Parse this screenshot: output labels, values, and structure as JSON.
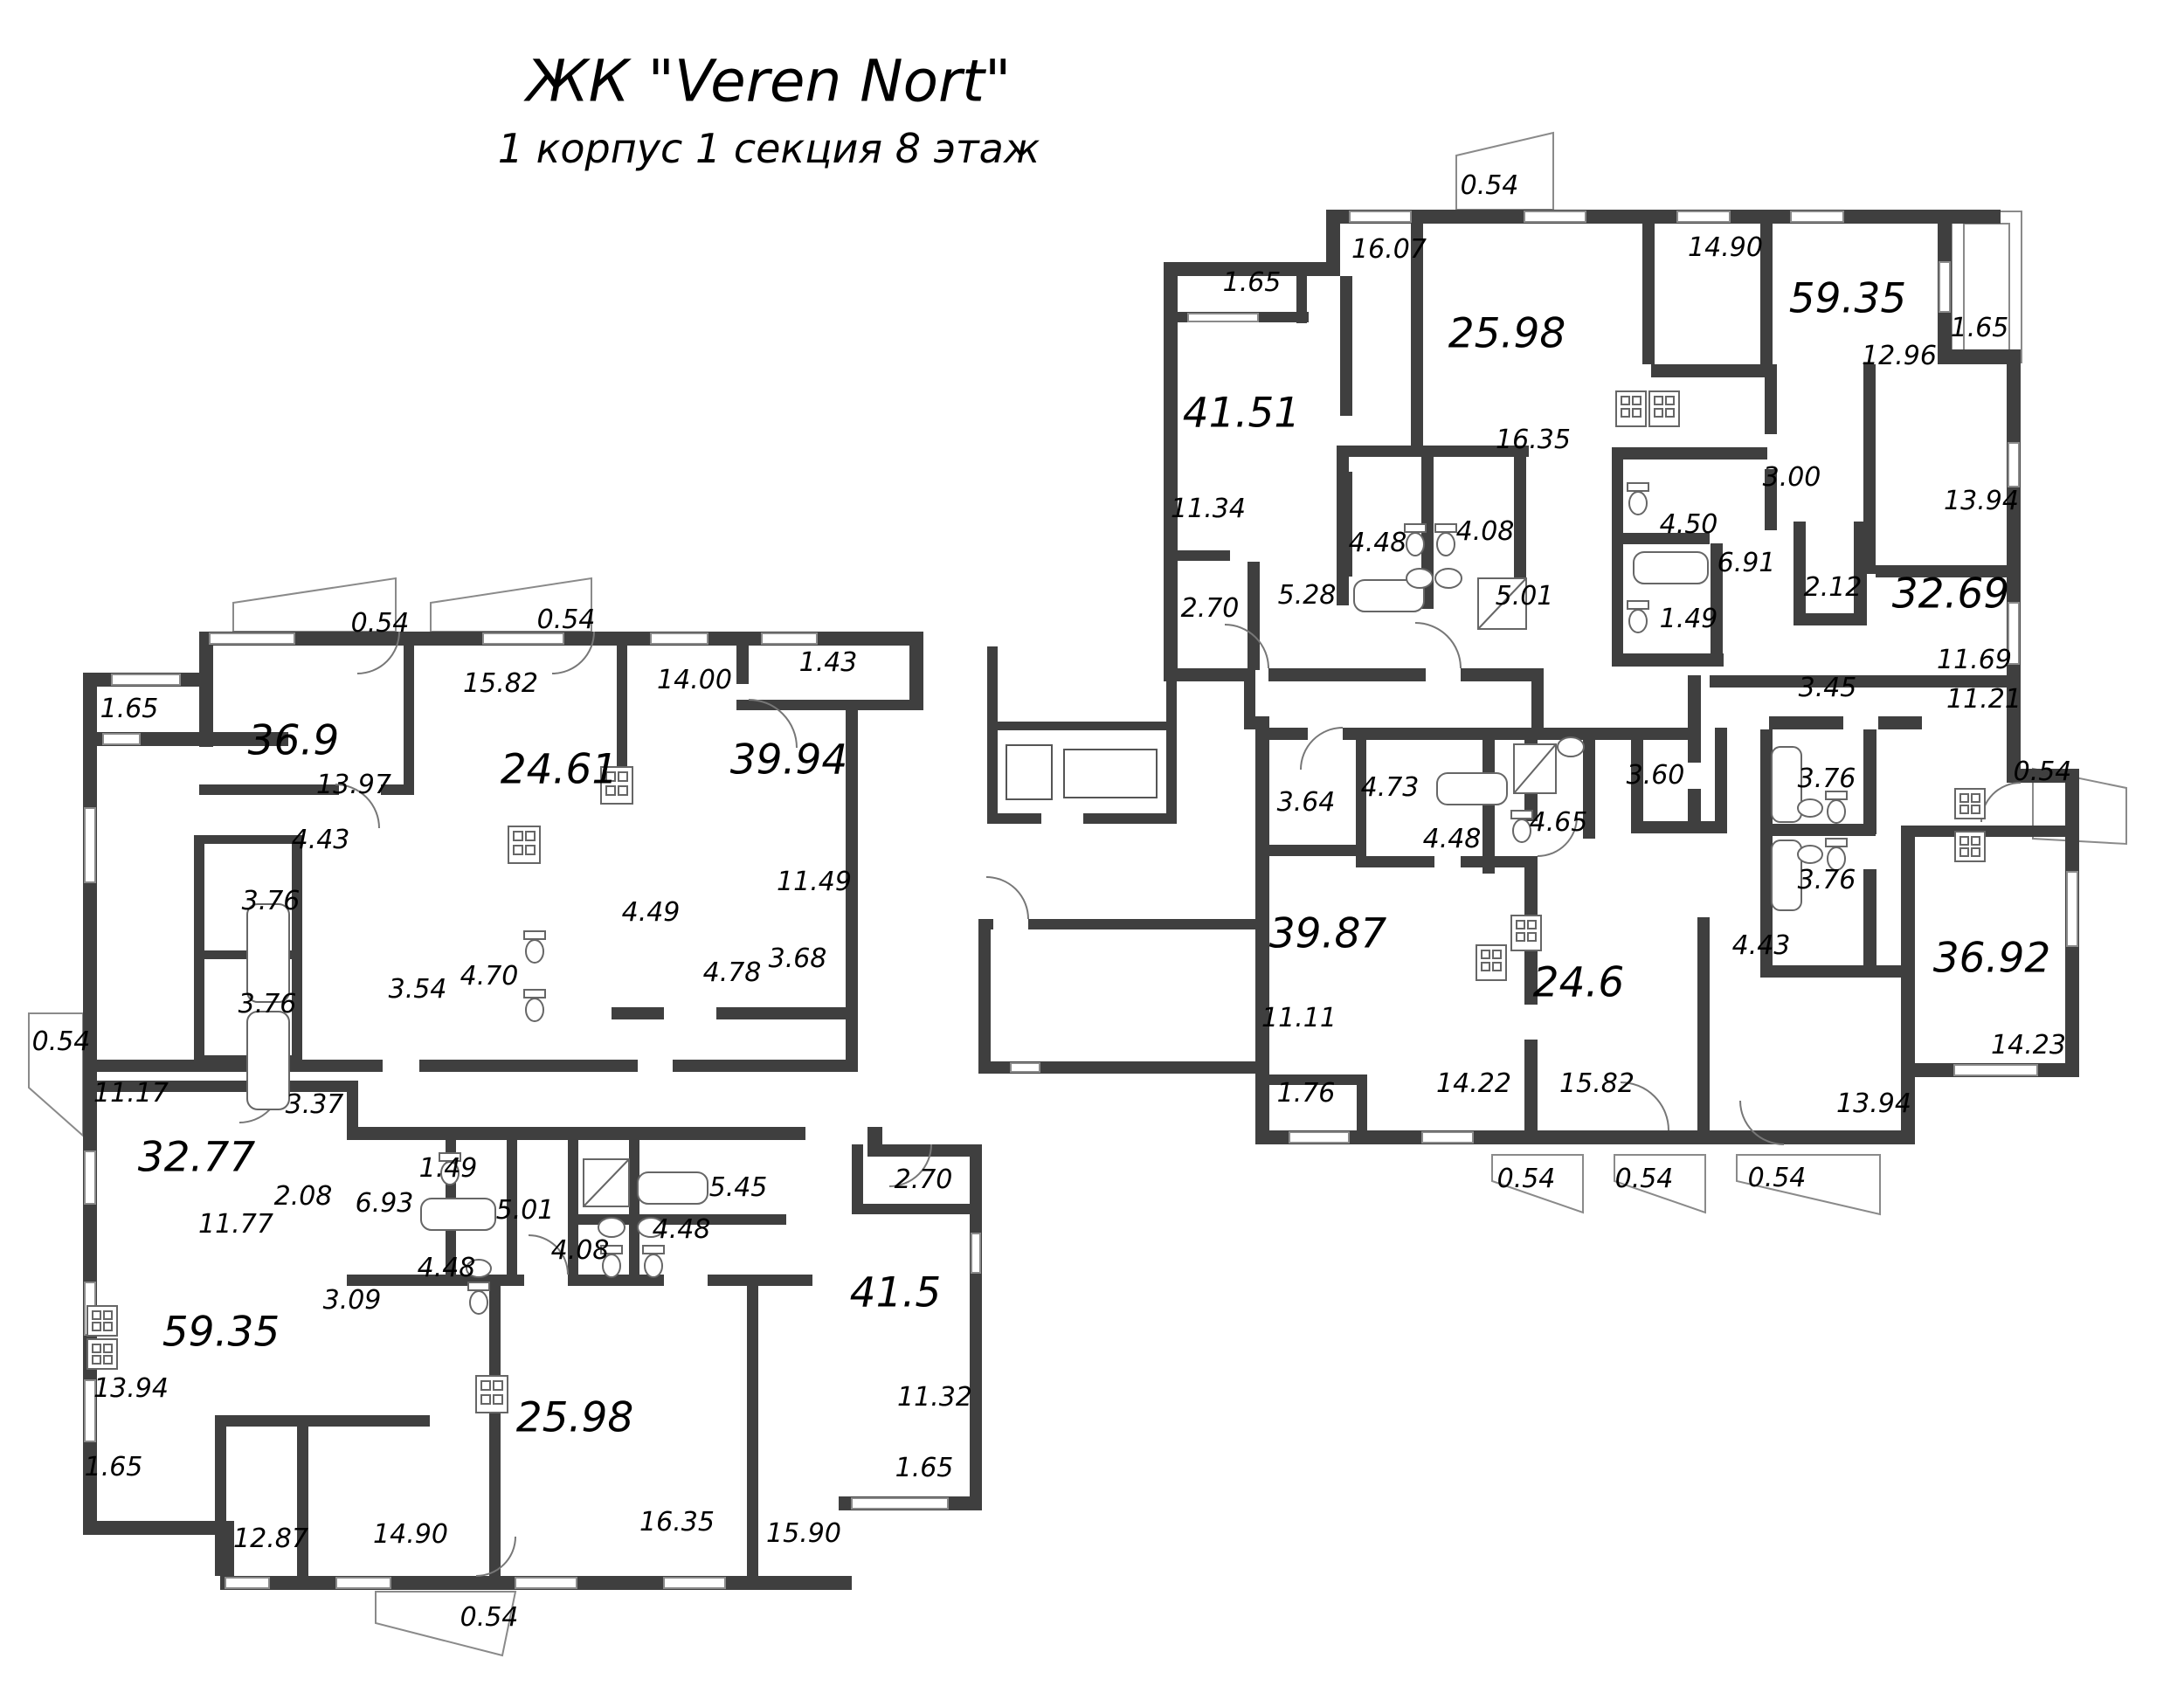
{
  "title": {
    "main": "ЖК \"Veren Nort\"",
    "subtitle": "1 корпус 1 секция 8 этаж"
  },
  "plan_type": "apartment floor plan",
  "labels": [
    "0.54",
    "0.54",
    "1.65",
    "36.9",
    "13.97",
    "15.82",
    "24.61",
    "14.00",
    "1.43",
    "39.94",
    "11.49",
    "4.43",
    "3.76",
    "3.76",
    "3.54",
    "4.70",
    "4.49",
    "4.78",
    "3.68",
    "0.54",
    "11.17",
    "32.77",
    "3.37",
    "2.08",
    "11.77",
    "6.93",
    "1.49",
    "4.48",
    "3.09",
    "5.01",
    "4.08",
    "4.48",
    "5.45",
    "2.70",
    "59.35",
    "13.94",
    "1.65",
    "12.87",
    "14.90",
    "25.98",
    "16.35",
    "15.90",
    "41.5",
    "11.32",
    "1.65",
    "0.54",
    "0.54",
    "1.65",
    "16.07",
    "25.98",
    "14.90",
    "59.35",
    "1.65",
    "12.96",
    "41.51",
    "16.35",
    "11.34",
    "4.48",
    "4.08",
    "3.00",
    "4.50",
    "6.91",
    "1.49",
    "13.94",
    "2.70",
    "5.28",
    "5.01",
    "2.12",
    "32.69",
    "11.69",
    "3.45",
    "11.21",
    "0.54",
    "3.76",
    "3.76",
    "3.64",
    "4.73",
    "4.48",
    "4.65",
    "3.60",
    "39.87",
    "11.11",
    "1.76",
    "24.6",
    "14.22",
    "15.82",
    "4.43",
    "36.92",
    "14.23",
    "13.94",
    "0.54",
    "0.54",
    "0.54"
  ]
}
